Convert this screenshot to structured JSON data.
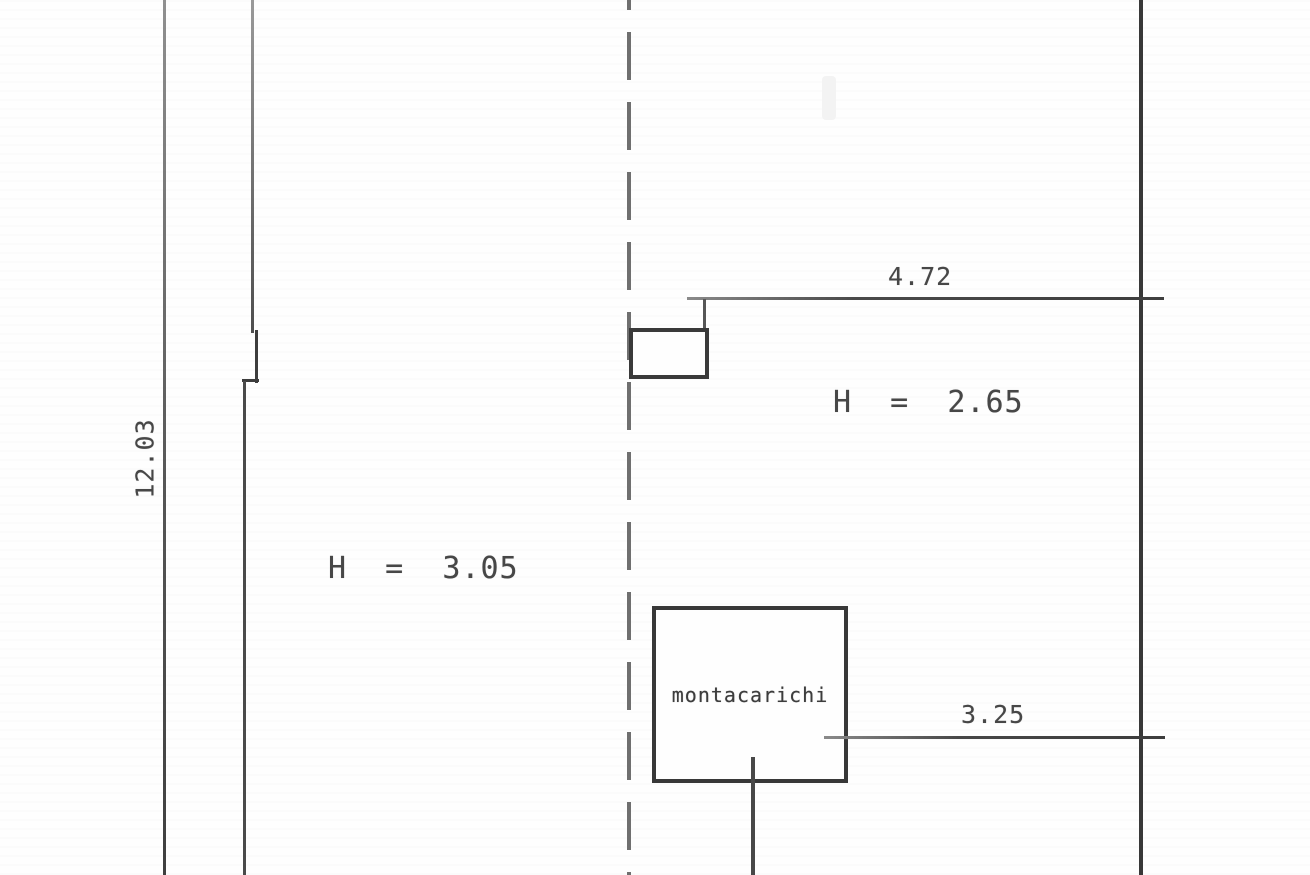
{
  "document": {
    "type": "architectural-floor-plan-scan",
    "labels": {
      "overall_depth": "12.03",
      "opening_top_width": "4.72",
      "opening_bottom_width": "3.25",
      "ceiling_height_right": "H  =  2.65",
      "ceiling_height_left": "H  =  3.05",
      "lift": "montacarichi"
    },
    "colors": {
      "background": "#fefefe",
      "wall_dark": "#383838",
      "wall_medium": "#4a4a4a",
      "wall_light": "#8c8c8c",
      "dashed_axis": "#6f6f6f",
      "text": "#474747"
    }
  }
}
